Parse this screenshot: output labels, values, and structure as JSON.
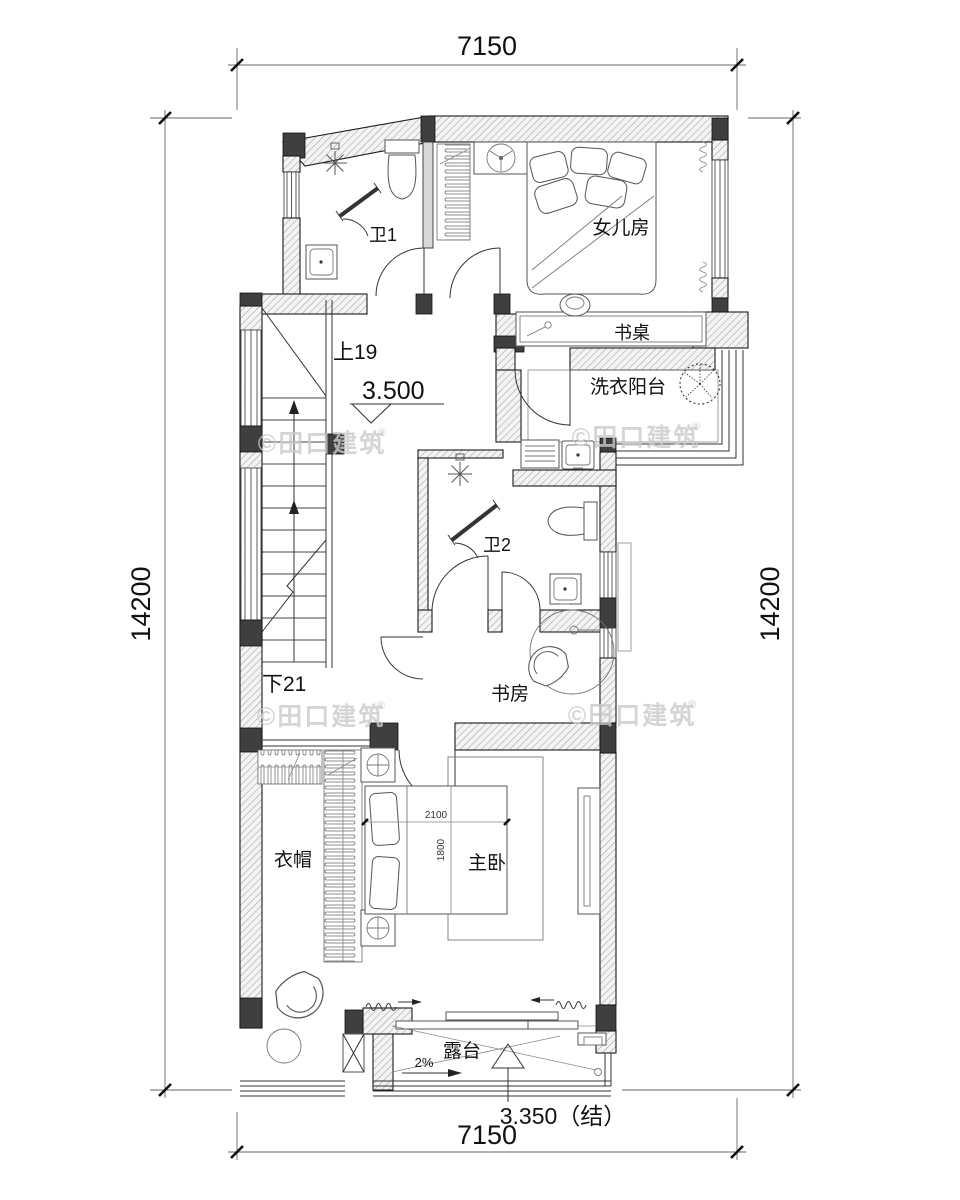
{
  "plan": {
    "dims": {
      "top": "7150",
      "bottom": "7150",
      "left": "14200",
      "right": "14200"
    },
    "levels": {
      "floor": "3.500",
      "terrace": "3.350（结）"
    },
    "stairs": {
      "up": "上19",
      "down": "下21"
    },
    "slope": "2%",
    "bed": {
      "length": "2100",
      "width": "1800"
    },
    "rooms": {
      "bath1": "卫1",
      "daughter": "女儿房",
      "desk": "书桌",
      "laundry": "洗衣阳台",
      "bath2": "卫2",
      "study": "书房",
      "cloak": "衣帽",
      "master": "主卧",
      "terrace": "露台"
    },
    "watermark": {
      "label": "©田口建筑",
      "reg": "®"
    }
  }
}
